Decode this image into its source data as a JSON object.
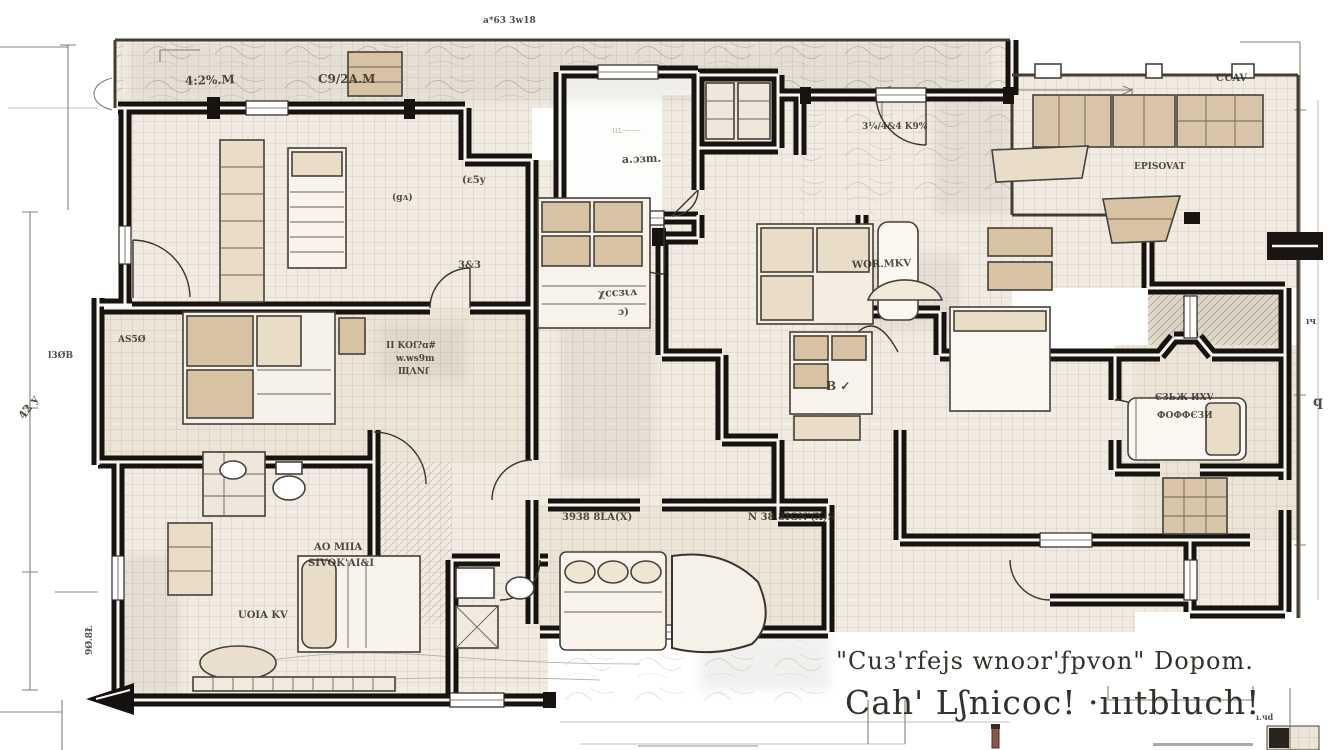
{
  "title": "Hand-drawn apartment floor plan sketch",
  "colors": {
    "paper": "#ffffff",
    "wall": "#17130e",
    "wall_core": "#f8f6f2",
    "floor_grid": "#cdc5b7",
    "floor_base": "#f1ebe2",
    "floor_warm": "#ece4d6",
    "tan": "#d7c2a3",
    "tan_light": "#e9ddc8",
    "ink": "#332d26",
    "dim_line": "#857e70",
    "caption": "#34302b"
  },
  "plan_labels": {
    "porch_left": "4:2%.M",
    "porch_right": "C9/2A.M",
    "top_small": "a*63 3w18",
    "white_room_faint": "uʟ——",
    "white_room": "a.ɔɜm.",
    "room_a_small": "(ɛ5y",
    "room_a_ga": "(gʌ)",
    "room_a_33": "3&3",
    "closet_as50": "AS5Ø",
    "margin_l30b": "l3ØB",
    "margin_42y": "42 y",
    "note_line1": "II KOſ?ɑ#",
    "note_line2": "w.ws9m",
    "note_line3": "ЩΛNſ",
    "hall_line1": "χccɜιʌ",
    "hall_line2": "ɔ)",
    "center_wqr": "WOR.MKV",
    "bed_b_check": "B ✓",
    "right_bed_line1": "ЄЗЬЖ ИXV",
    "right_bed_line2": "ФОФФЄЗИ",
    "kitchen": "EPISOVAT",
    "cuav": "CUAV",
    "dim_top_right": "3¼/4&4 K9%",
    "margin_right_q": "q",
    "margin_right_iy": "ıч",
    "living_uoia": "UOIA KV",
    "living_ao1": "AO MIIA",
    "living_ao2": "SIVOK'AI&I",
    "bed_f_1": "3938 8LA(X)",
    "bed_f_2": "N 38.8IGN'(X)S",
    "left_vertical": "9Ø.8Ł",
    "dim_bottom_small": "ı.чd"
  },
  "caption": {
    "line1": "\"Cuɜ'rfejs wnoɔr'ƒpvon\" Dopom.",
    "line2": "Cah' Lʃnicoc! ·ıııtbluch!"
  }
}
